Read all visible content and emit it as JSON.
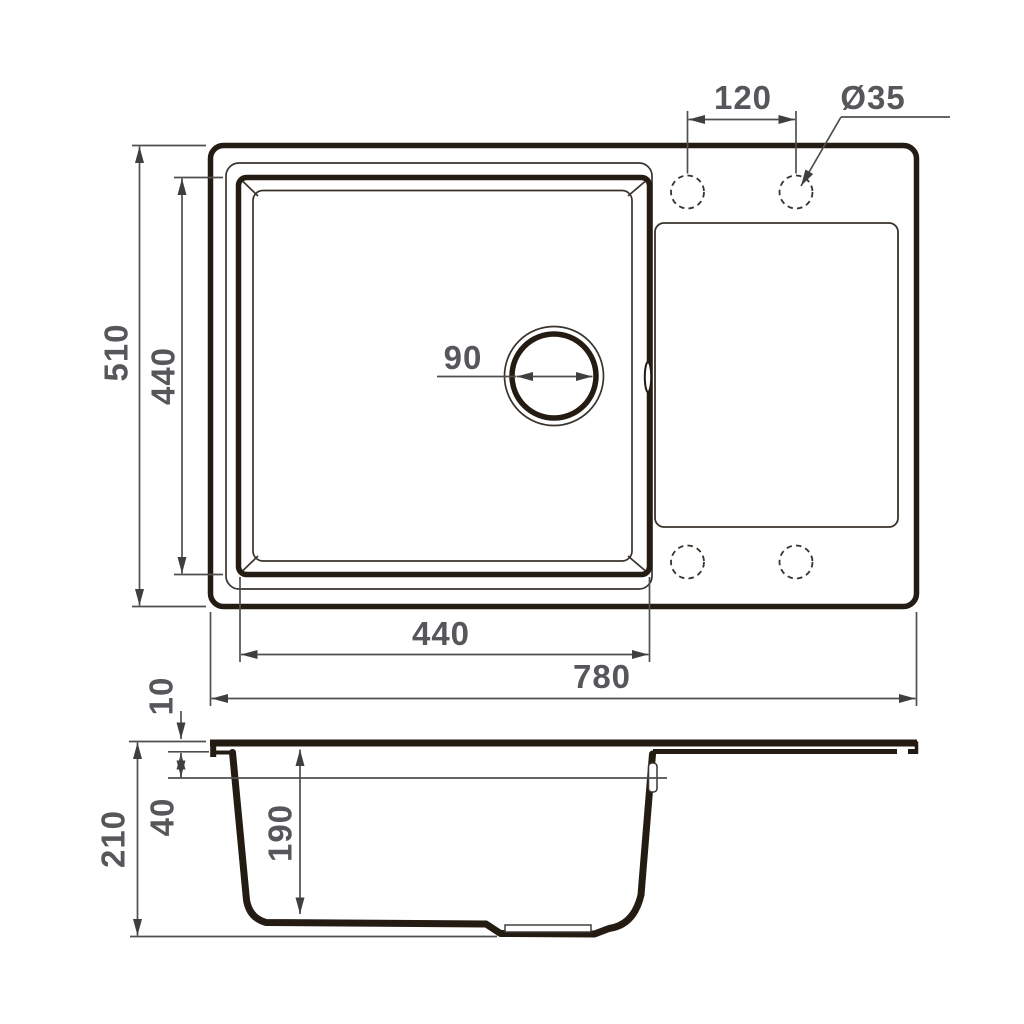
{
  "meta": {
    "drawing_type": "kitchen sink technical drawing, top view and side section",
    "background": "#ffffff",
    "heavy_line_color": "#241b12",
    "light_line_color": "#3a332c",
    "dim_line_color": "#4f4f4f",
    "text_color": "#56575a"
  },
  "dimensions": {
    "top_view": {
      "overall_width": "780",
      "overall_depth": "510",
      "bowl_width": "440",
      "bowl_depth": "440",
      "drain_diameter": "90",
      "faucet_hole_spacing": "120",
      "faucet_hole_diameter": "Ø35"
    },
    "side_view": {
      "total_height": "210",
      "rim_thickness": "10",
      "ledge_depth": "40",
      "bowl_depth": "190"
    }
  }
}
